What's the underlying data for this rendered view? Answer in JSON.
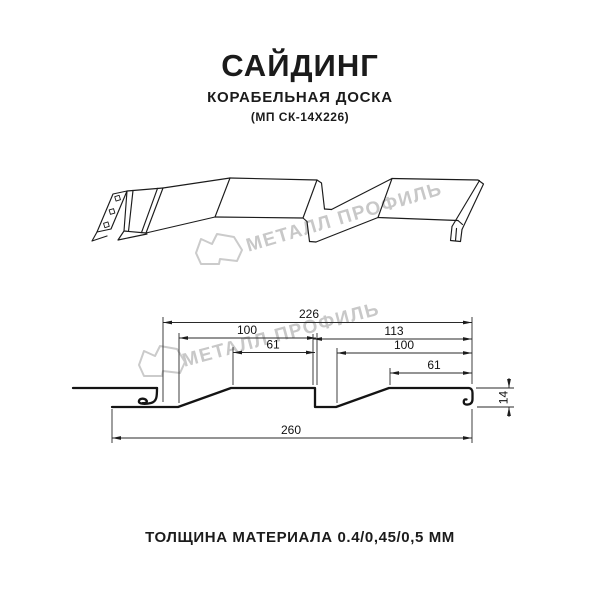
{
  "header": {
    "title": "САЙДИНГ",
    "subtitle": "КОРАБЕЛЬНАЯ ДОСКА",
    "model": "(МП СК-14Х226)"
  },
  "watermark": {
    "brand": "МЕТАЛЛ ПРОФИЛЬ"
  },
  "section": {
    "dims": {
      "module": "226",
      "board1": "100",
      "flat1": "61",
      "right_span": "113",
      "board2": "100",
      "flat2": "61",
      "height": "14",
      "overall": "260"
    }
  },
  "footer": {
    "thickness_label": "ТОЛЩИНА МАТЕРИАЛА 0.4/0,45/0,5 ММ"
  },
  "colors": {
    "line": "#1c1c1c",
    "watermark": "#c8c8c8",
    "text": "#1b1b1b",
    "background": "#ffffff"
  }
}
